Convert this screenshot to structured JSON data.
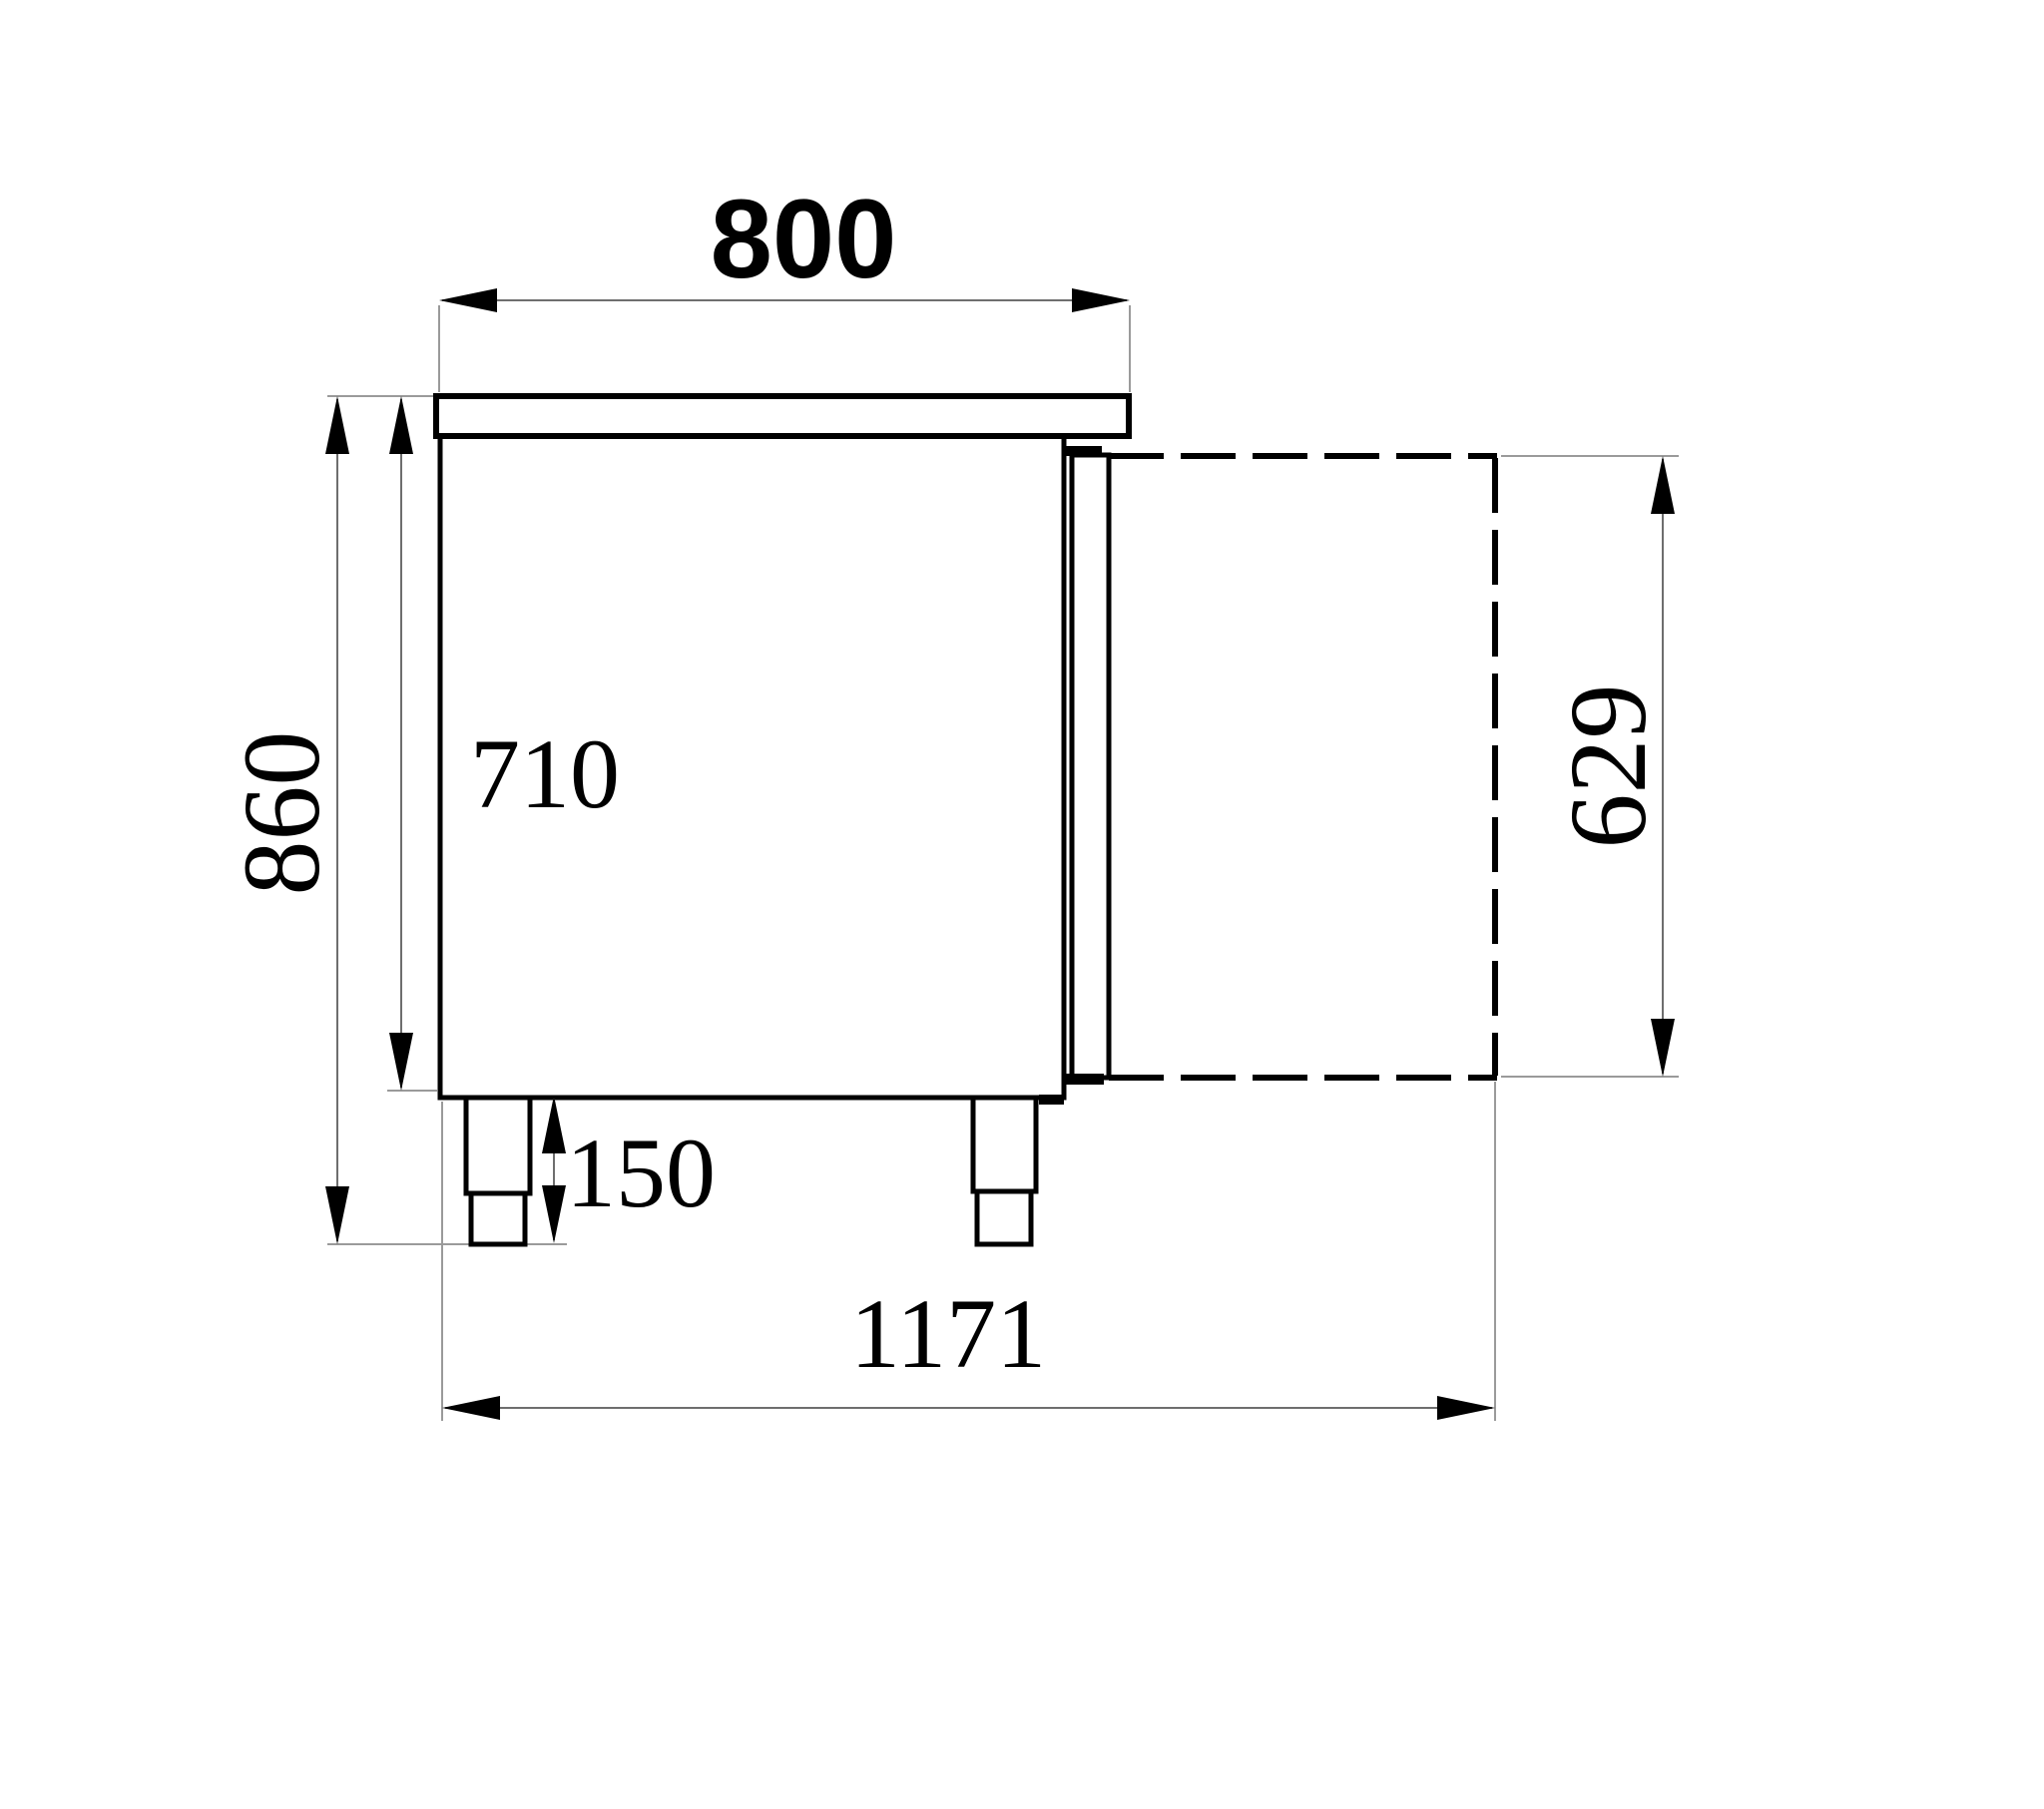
{
  "drawing": {
    "background_color": "#ffffff",
    "outline_color": "#000000",
    "dimension_line_color": "#6e6e6e",
    "extension_line_color": "#9a9a9a",
    "dimensions": {
      "top_width": {
        "label": "800"
      },
      "overall_height": {
        "label": "860"
      },
      "body_height": {
        "label": "710"
      },
      "door_open_height": {
        "label": "629"
      },
      "leg_height": {
        "label": "150"
      },
      "overall_depth_door_open": {
        "label": "1171"
      }
    }
  }
}
